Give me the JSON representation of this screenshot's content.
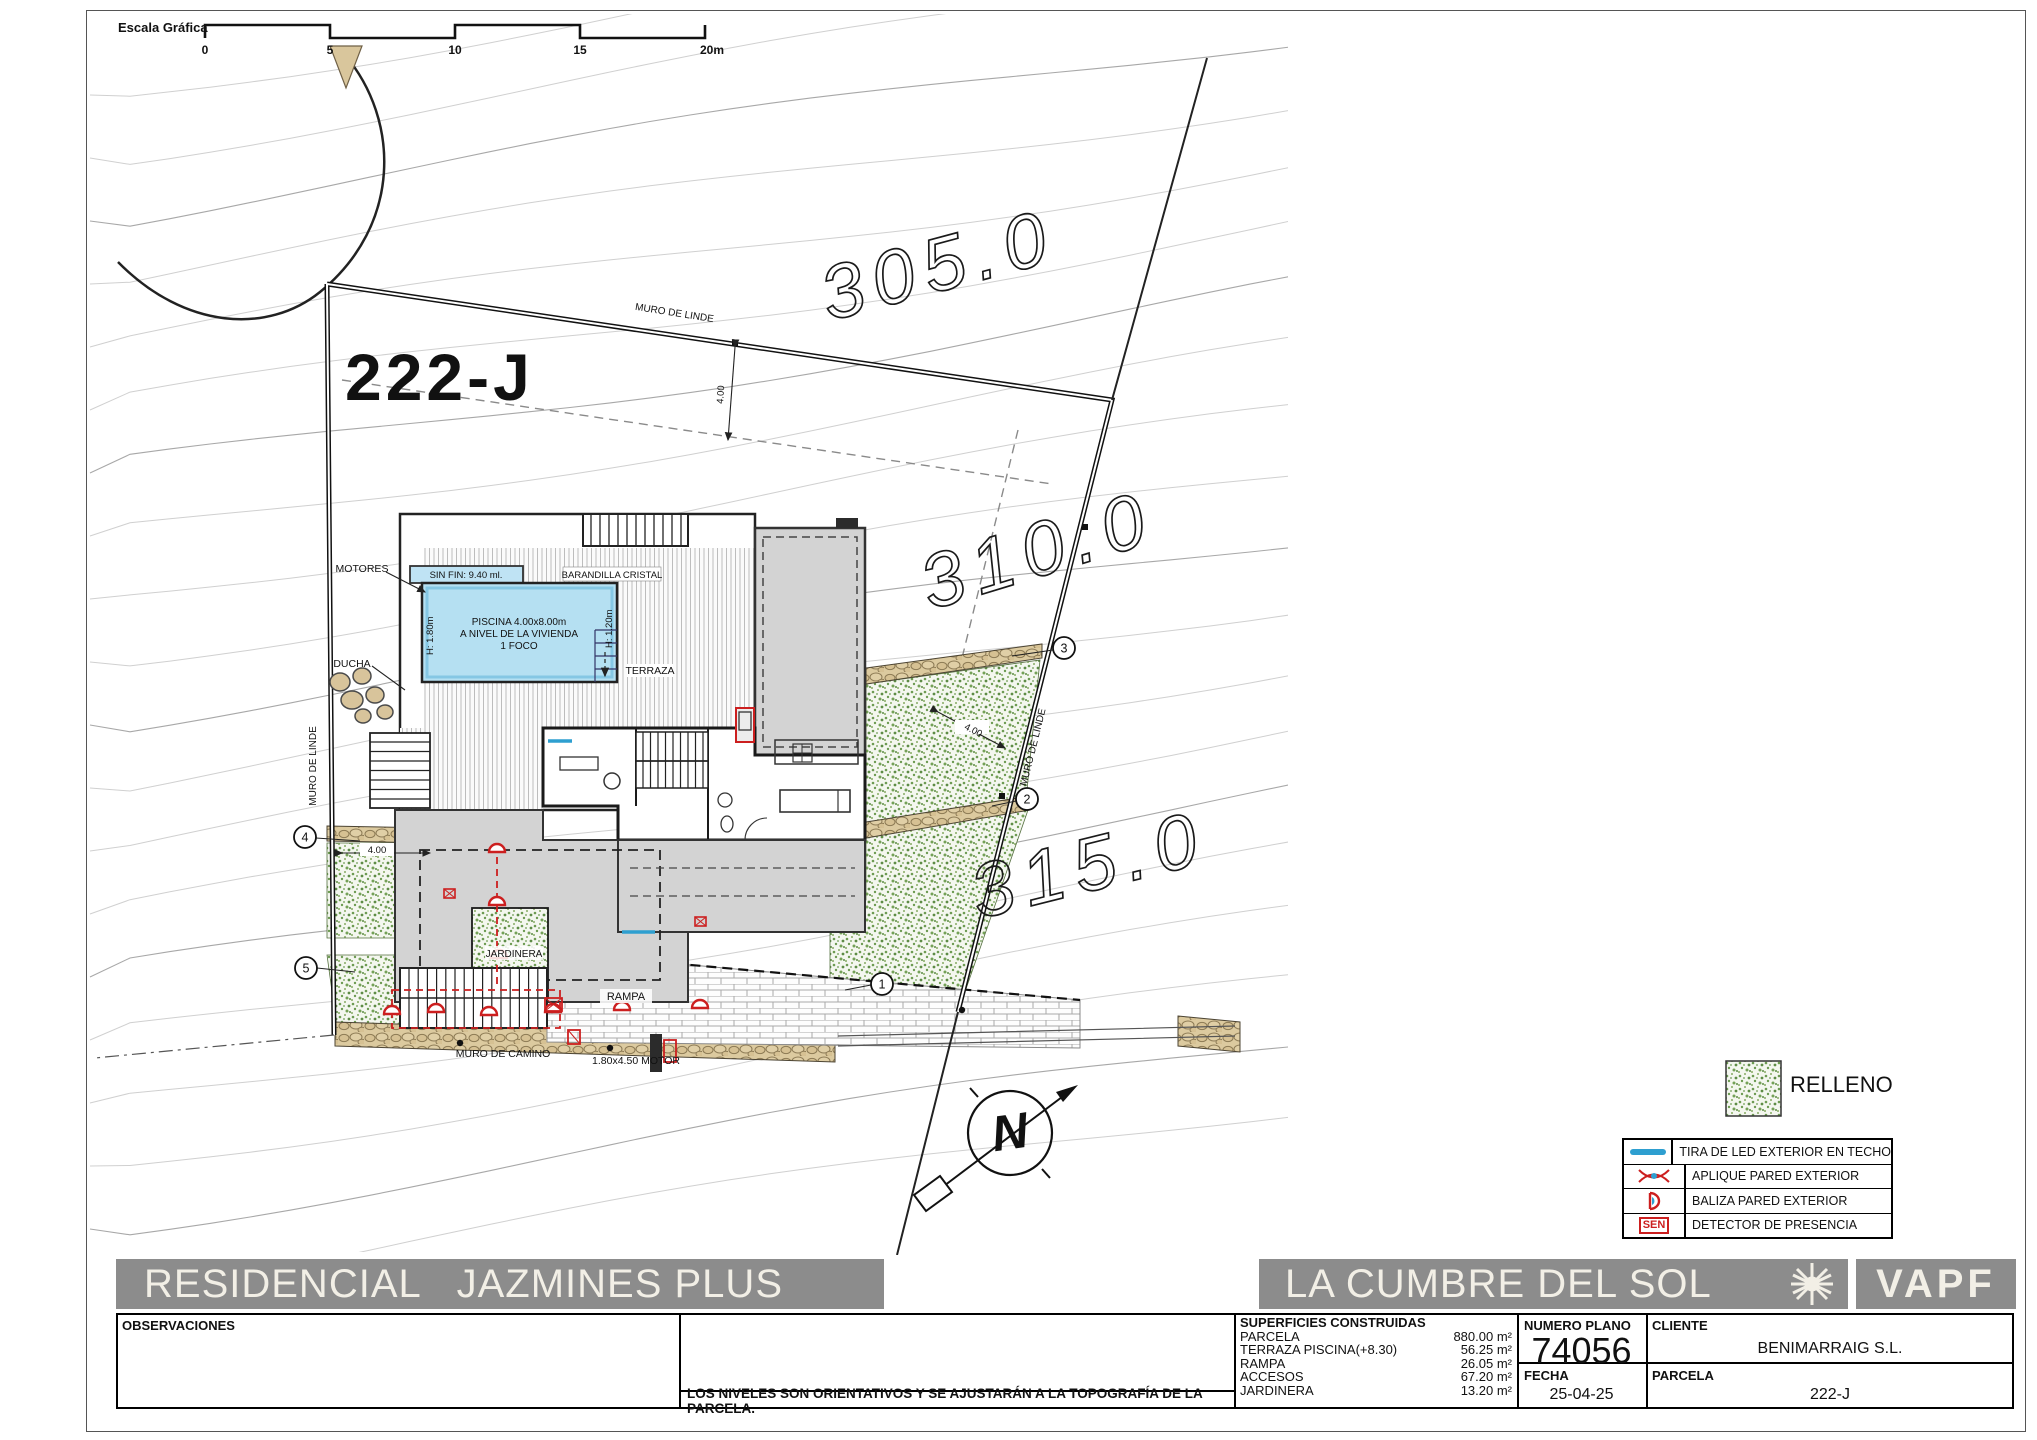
{
  "scale_bar": {
    "label": "Escala Gráfica",
    "ticks": [
      "0",
      "5",
      "10",
      "15",
      "20m"
    ]
  },
  "plan": {
    "parcel_label": "222-J",
    "contours": {
      "c305": "305.0",
      "c310": "310.0",
      "c315": "315.0"
    },
    "muro_linde_top": "MURO DE LINDE",
    "muro_linde_right": "MURO DE LINDE",
    "muro_linde_left": "MURO DE LINDE",
    "dim_top": "4.00",
    "dim_right": "4.00",
    "dim_left": "4.00",
    "pool": {
      "sinfin": "SIN FIN: 9.40 ml.",
      "barandilla": "BARANDILLA CRISTAL",
      "line1": "PISCINA 4.00x8.00m",
      "line2": "A NIVEL DE LA VIVIENDA",
      "line3": "1 FOCO",
      "h_left": "H: 1.80m",
      "h_right": "H: 1.20m"
    },
    "labels": {
      "motores": "MOTORES",
      "ducha": "DUCHA",
      "terraza": "TERRAZA",
      "jardinera": "JARDINERA",
      "rampa": "RAMPA",
      "muro_camino": "MURO DE CAMINO",
      "motor": "1.80x4.50 MOTOR"
    },
    "markers": [
      "1",
      "2",
      "3",
      "4",
      "5"
    ],
    "north_letter": "N"
  },
  "legend": {
    "relleno_label": "RELLENO",
    "items": [
      {
        "label": "TIRA DE LED EXTERIOR EN TECHO"
      },
      {
        "label": "APLIQUE PARED EXTERIOR"
      },
      {
        "label": "BALIZA PARED EXTERIOR"
      },
      {
        "label": "DETECTOR DE PRESENCIA",
        "icon_text": "SEN"
      }
    ]
  },
  "titlebar": {
    "left": "RESIDENCIAL   JAZMINES PLUS",
    "right": "LA CUMBRE DEL SOL",
    "brand": "VAPF"
  },
  "titleblock": {
    "observaciones_label": "OBSERVACIONES",
    "note": "LOS NIVELES SON ORIENTATIVOS Y SE AJUSTARÁN A LA TOPOGRAFÍA DE LA PARCELA.",
    "superficies": {
      "header": "SUPERFICIES CONSTRUIDAS",
      "rows": [
        [
          "PARCELA",
          "880.00 m²"
        ],
        [
          "TERRAZA PISCINA(+8.30)",
          "56.25 m²"
        ],
        [
          "RAMPA",
          "26.05 m²"
        ],
        [
          "ACCESOS",
          "67.20 m²"
        ],
        [
          "JARDINERA",
          "13.20 m²"
        ]
      ]
    },
    "numero_plano_label": "NUMERO PLANO",
    "numero_plano_value": "74056",
    "cliente_label": "CLIENTE",
    "cliente_value": "BENIMARRAIG S.L.",
    "fecha_label": "FECHA",
    "fecha_value": "25-04-25",
    "parcela_label": "PARCELA",
    "parcela_value": "222-J"
  },
  "colors": {
    "bar_gray": "#8c8c8c",
    "pool_blue": "#b5e0f2",
    "relleno_green": "#6d9b52",
    "wall_tan": "#d9c69c",
    "symbol_red": "#cc1f1f",
    "led_blue": "#2e9fd0"
  }
}
